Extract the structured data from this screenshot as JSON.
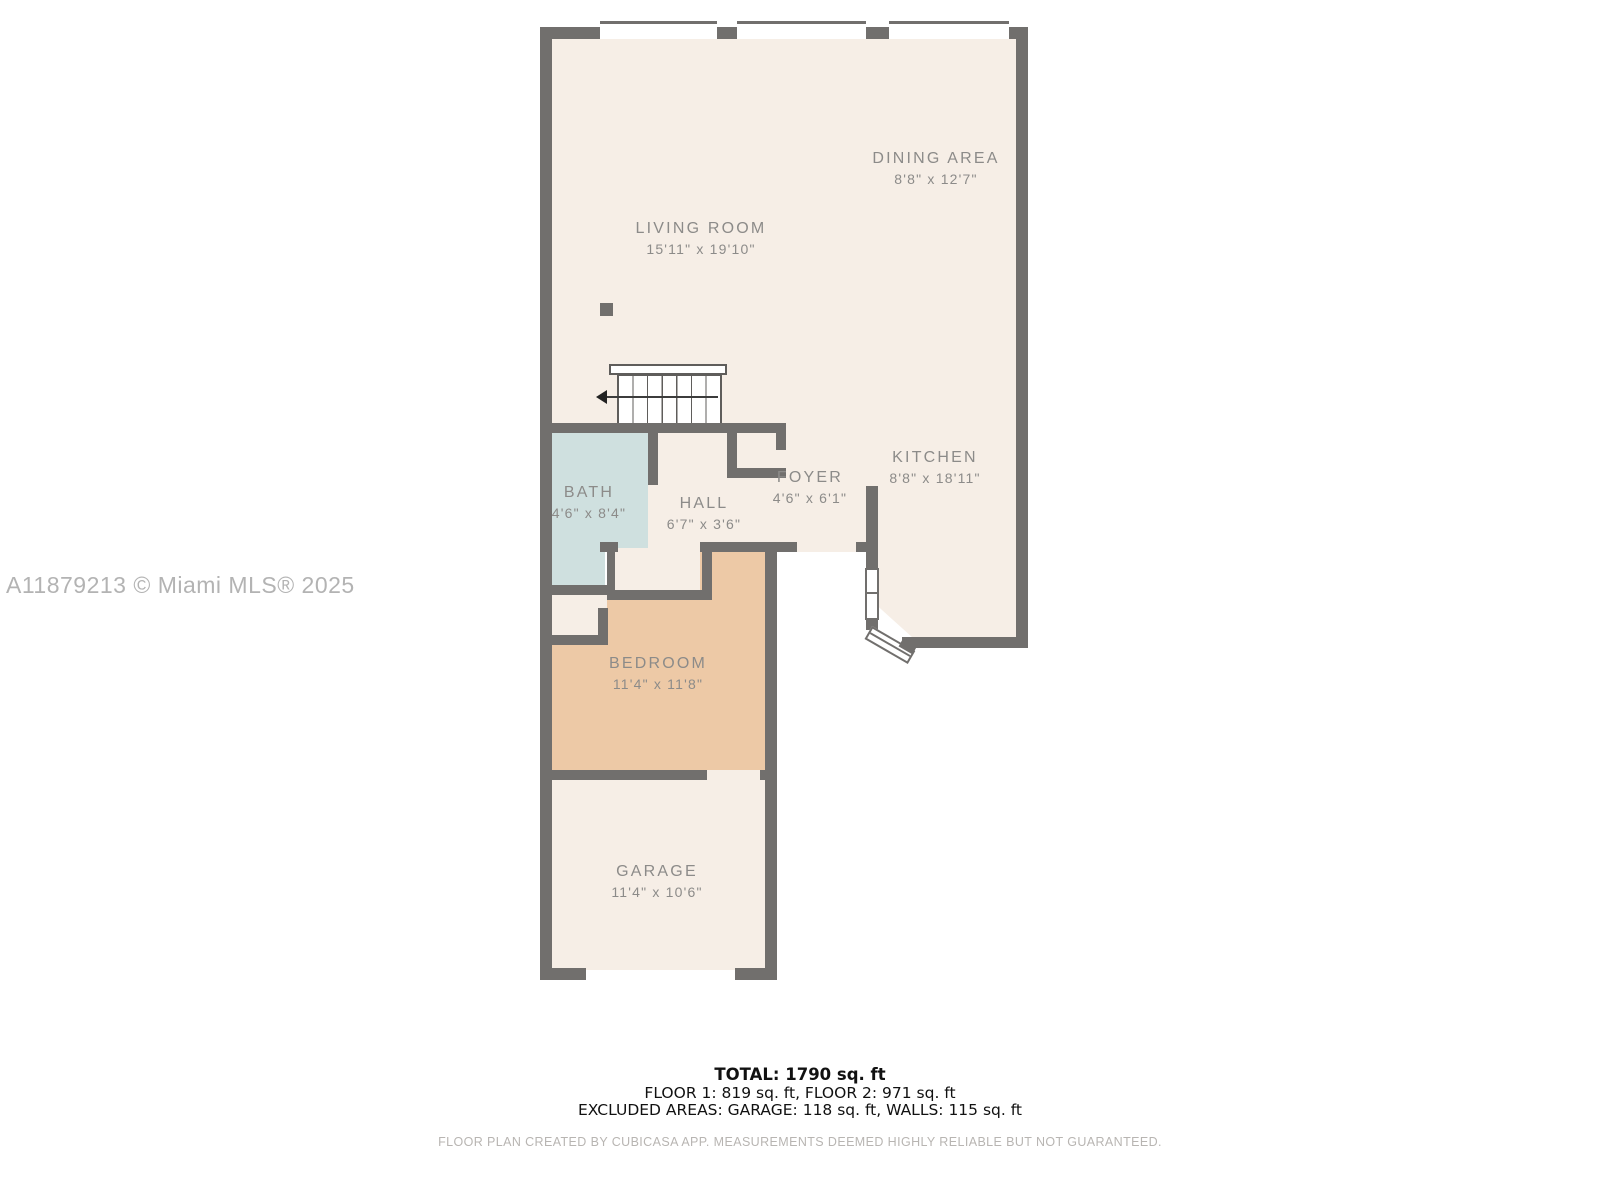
{
  "watermark": "A11879213 © Miami MLS® 2025",
  "rooms": {
    "living": {
      "name": "LIVING ROOM",
      "dims": "15'11\" x 19'10\""
    },
    "dining": {
      "name": "DINING AREA",
      "dims": "8'8\" x 12'7\""
    },
    "kitchen": {
      "name": "KITCHEN",
      "dims": "8'8\" x 18'11\""
    },
    "foyer": {
      "name": "FOYER",
      "dims": "4'6\" x 6'1\""
    },
    "hall": {
      "name": "HALL",
      "dims": "6'7\" x 3'6\""
    },
    "bath": {
      "name": "BATH",
      "dims": "4'6\" x 8'4\""
    },
    "bedroom": {
      "name": "BEDROOM",
      "dims": "11'4\" x 11'8\""
    },
    "garage": {
      "name": "GARAGE",
      "dims": "11'4\" x 10'6\""
    }
  },
  "summary": {
    "total": "TOTAL: 1790 sq. ft",
    "floors": "FLOOR 1: 819 sq. ft, FLOOR 2: 971 sq. ft",
    "excluded": "EXCLUDED AREAS: GARAGE: 118 sq. ft, WALLS: 115 sq. ft"
  },
  "footer": "FLOOR PLAN CREATED BY CUBICASA APP. MEASUREMENTS DEEMED HIGHLY RELIABLE BUT NOT GUARANTEED.",
  "colors": {
    "wall": "#716f6d",
    "room_fill": "#f6eee6",
    "bath_fill": "#cfe0df",
    "bedroom_fill": "#edc9a6",
    "label_text": "#8c8b89"
  }
}
